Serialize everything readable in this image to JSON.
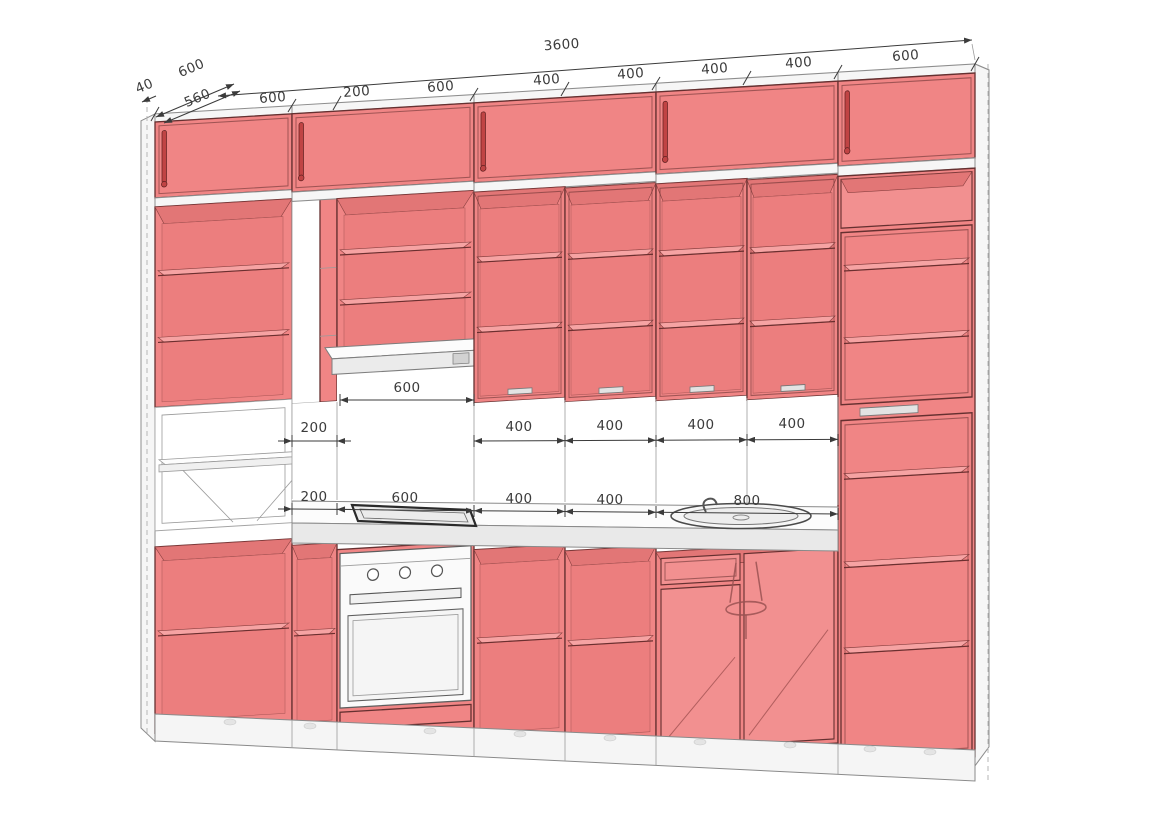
{
  "drawing": {
    "units": "mm",
    "style": "3d-kitchen-elevation",
    "colors": {
      "cabinet": "#f08585",
      "cabinet_shadow": "#e27676",
      "cabinet_edge": "#653030",
      "surface_white": "#f6f6f6",
      "outline_gray": "#8d8d8d",
      "dimension_text": "#3b3b3b"
    },
    "dimensions": {
      "overall_width": "3600",
      "top_row": [
        "600",
        "200",
        "600",
        "400",
        "400",
        "400",
        "400",
        "600"
      ],
      "depth_row": [
        "600",
        "40",
        "560"
      ],
      "hood_clearance": "600",
      "mid_row": [
        "200",
        "400",
        "400",
        "400",
        "400"
      ],
      "base_row": [
        "200",
        "600",
        "400",
        "400",
        "800"
      ]
    }
  }
}
